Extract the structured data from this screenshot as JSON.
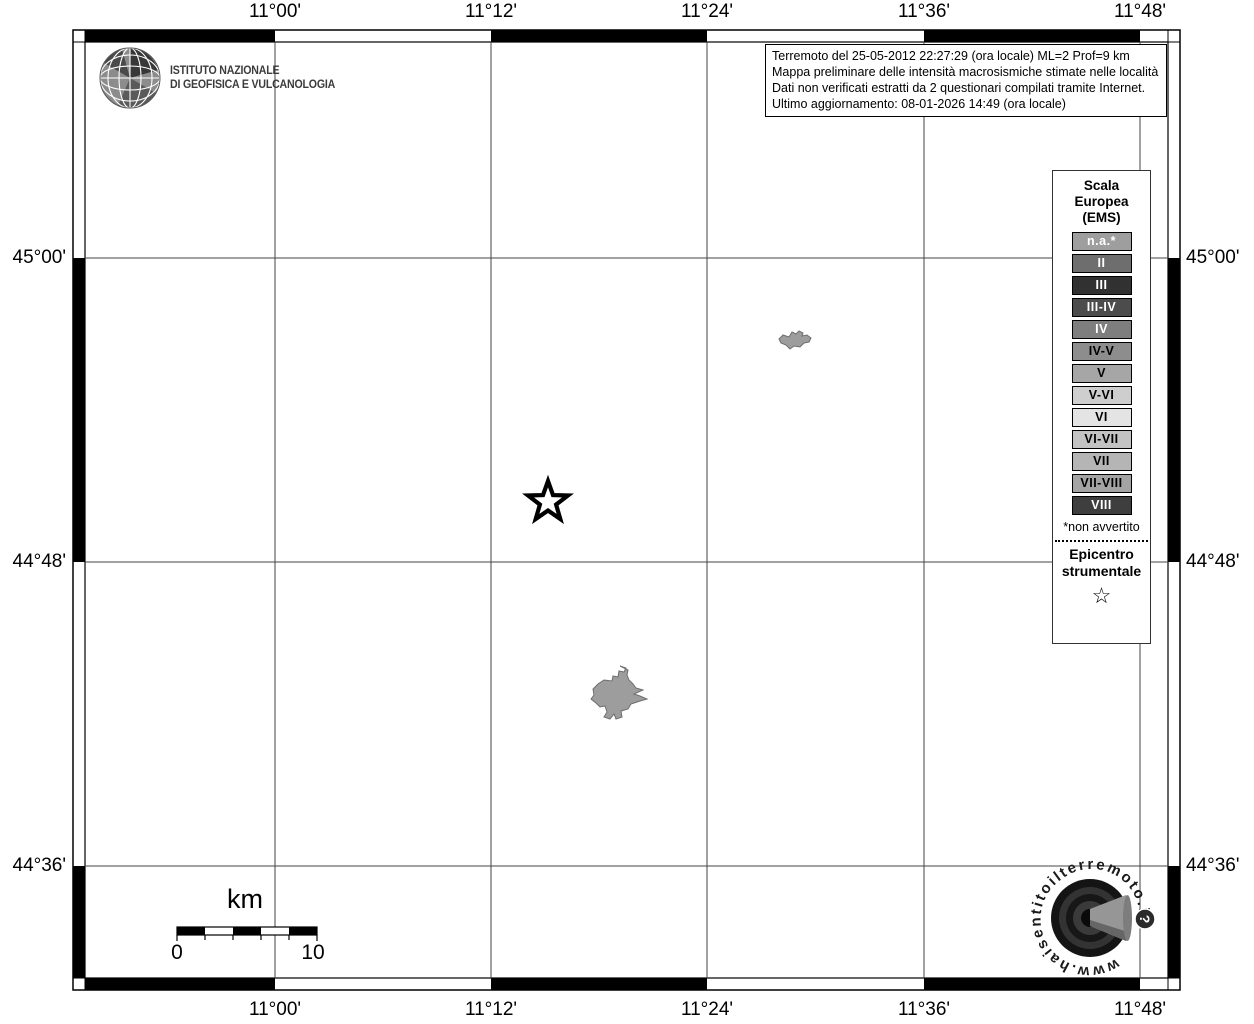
{
  "axis": {
    "top": [
      "11°00'",
      "11°12'",
      "11°24'",
      "11°36'",
      "11°48'"
    ],
    "bottom": [
      "11°00'",
      "11°12'",
      "11°24'",
      "11°36'",
      "11°48'"
    ],
    "left": [
      "45°00'",
      "44°48'",
      "44°36'"
    ],
    "right": [
      "45°00'",
      "44°48'",
      "44°36'"
    ]
  },
  "info_box": {
    "lines": [
      "Terremoto del 25-05-2012 22:27:29 (ora locale) ML=2 Prof=9 km",
      "Mappa preliminare delle intensità macrosismiche stimate nelle località",
      "Dati non verificati estratti da 2 questionari compilati tramite Internet.",
      "Ultimo aggiornamento: 08-01-2026 14:49 (ora locale)"
    ]
  },
  "ingv_logo": {
    "line1": "ISTITUTO NAZIONALE",
    "line2": "DI GEOFISICA E VULCANOLOGIA"
  },
  "legend": {
    "title_line1": "Scala",
    "title_line2": "Europea",
    "title_line3": "(EMS)",
    "items": [
      {
        "label": "n.a.*",
        "bg": "#9e9e9e",
        "fg": "#ffffff"
      },
      {
        "label": "II",
        "bg": "#6e6e6e",
        "fg": "#ffffff"
      },
      {
        "label": "III",
        "bg": "#313131",
        "fg": "#ffffff"
      },
      {
        "label": "III-IV",
        "bg": "#4c4c4c",
        "fg": "#ffffff"
      },
      {
        "label": "IV",
        "bg": "#7e7e7e",
        "fg": "#ffffff"
      },
      {
        "label": "IV-V",
        "bg": "#8d8d8d",
        "fg": "#000000"
      },
      {
        "label": "V",
        "bg": "#a6a6a6",
        "fg": "#000000"
      },
      {
        "label": "V-VI",
        "bg": "#cecece",
        "fg": "#000000"
      },
      {
        "label": "VI",
        "bg": "#e4e4e4",
        "fg": "#000000"
      },
      {
        "label": "VI-VII",
        "bg": "#c3c3c3",
        "fg": "#000000"
      },
      {
        "label": "VII",
        "bg": "#b5b5b5",
        "fg": "#000000"
      },
      {
        "label": "VII-VIII",
        "bg": "#a4a4a4",
        "fg": "#000000"
      },
      {
        "label": "VIII",
        "bg": "#3e3e3e",
        "fg": "#ffffff"
      }
    ],
    "footnote": "*non avvertito",
    "epicenter_line1": "Epicentro",
    "epicenter_line2": "strumentale",
    "epicenter_symbol": "☆"
  },
  "scale_bar": {
    "unit_label": "km",
    "min_label": "0",
    "max_label": "10"
  },
  "hsit_logo": {
    "ring_text": "www.haisentitoilterremoto.it",
    "badge_label": "?"
  },
  "colors": {
    "locality_fill": "#9d9d9d",
    "locality_stroke": "#6e6e6e",
    "grid_line": "#444444"
  }
}
